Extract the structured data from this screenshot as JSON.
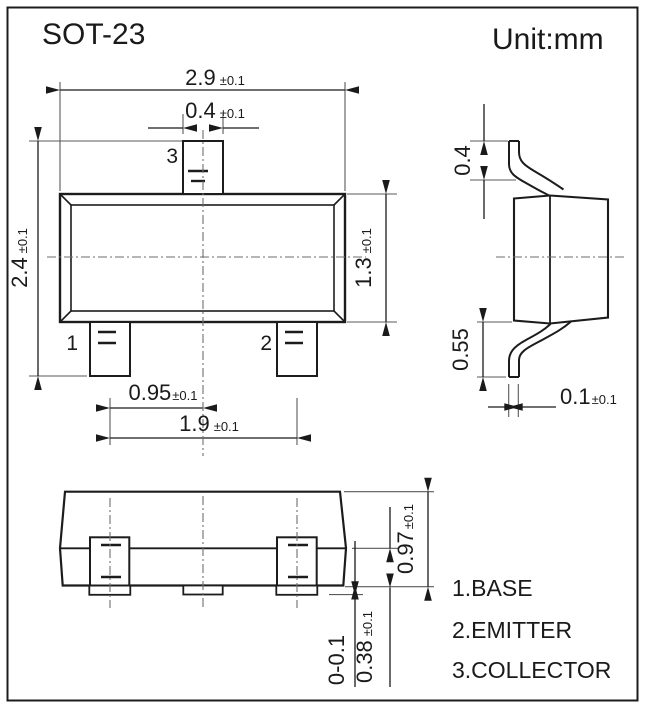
{
  "title": "SOT-23",
  "unit_label": "Unit:mm",
  "pin_labels": {
    "p1": "1",
    "p2": "2",
    "p3": "3"
  },
  "legend": {
    "base": "1.BASE",
    "emitter": "2.EMITTER",
    "collector": "3.COLLECTOR"
  },
  "dims": {
    "body_width": {
      "v": "2.9",
      "t": "±0.1"
    },
    "lead_width": {
      "v": "0.4",
      "t": "±0.1"
    },
    "overall_height": {
      "v": "2.4",
      "t": "±0.1"
    },
    "body_height": {
      "v": "1.3",
      "t": "±0.1"
    },
    "lead_pitch": {
      "v": "0.95",
      "t": "±0.1"
    },
    "lead_span": {
      "v": "1.9",
      "t": "±0.1"
    },
    "side_top_lead": {
      "v": "0.4"
    },
    "side_bottom_lead": {
      "v": "0.55"
    },
    "standoff": {
      "v": "0.1",
      "t": "±0.1"
    },
    "front_height": {
      "v": "0.97",
      "t": "±0.1"
    },
    "front_standoff": {
      "v": "0-0.1"
    },
    "front_lead_len": {
      "v": "0.38",
      "t": "±0.1"
    }
  },
  "colors": {
    "line": "#1c1c1c",
    "thin_line": "#5a5a5a",
    "background": "#ffffff"
  }
}
